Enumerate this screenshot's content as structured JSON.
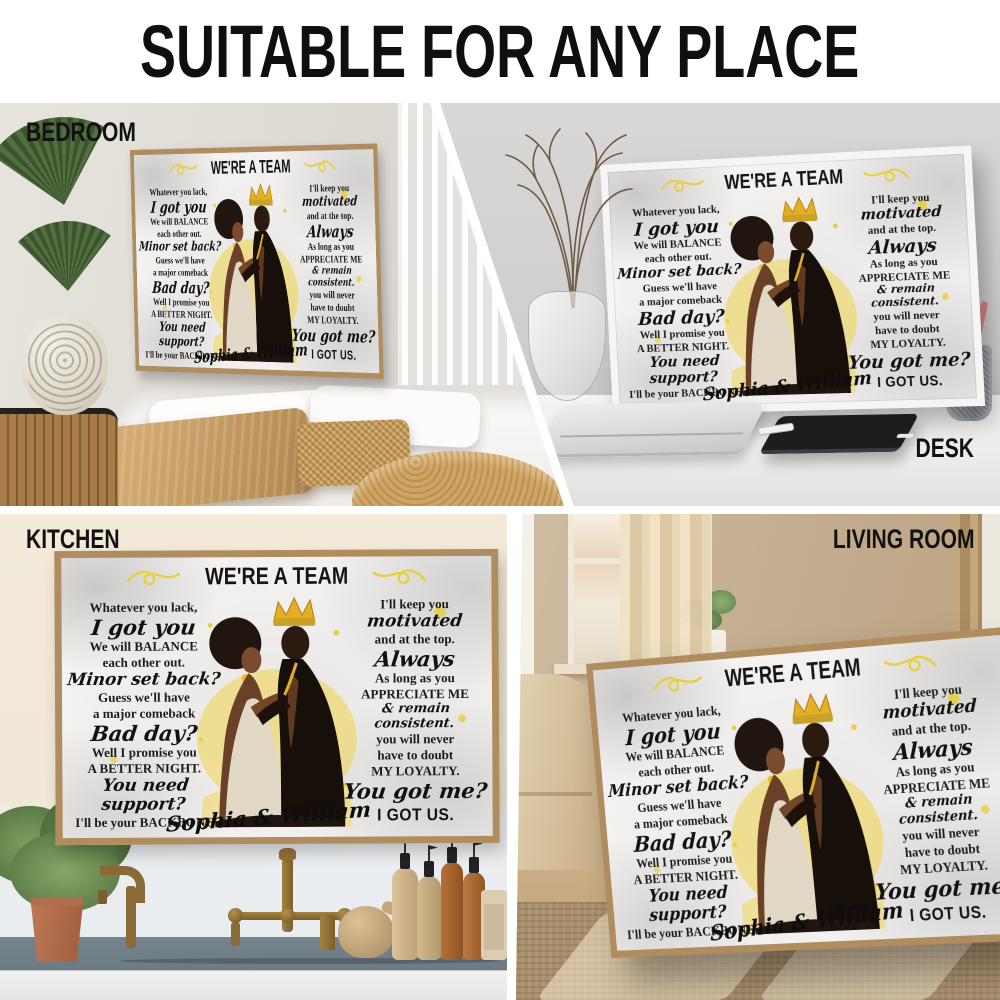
{
  "header": {
    "title": "SUITABLE FOR ANY PLACE"
  },
  "scenes": {
    "bedroom": {
      "label": "BEDROOM"
    },
    "desk": {
      "label": "DESK"
    },
    "kitchen": {
      "label": "KITCHEN"
    },
    "living_room": {
      "label": "LIVING ROOM"
    }
  },
  "poster": {
    "title": "WE'RE A TEAM",
    "names": "Sophia & William",
    "left_lines": [
      {
        "t": "Whatever you lack,",
        "s": "serif"
      },
      {
        "t": "I got you",
        "s": "script-lg"
      },
      {
        "t": "We will BALANCE",
        "s": "serif"
      },
      {
        "t": "each other out.",
        "s": "serif"
      },
      {
        "t": "Minor set back?",
        "s": "script"
      },
      {
        "t": "Guess we'll have",
        "s": "serif"
      },
      {
        "t": "a major comeback",
        "s": "serif"
      },
      {
        "t": "Bad day?",
        "s": "script-lg"
      },
      {
        "t": "Well I promise you",
        "s": "serif"
      },
      {
        "t": "A BETTER NIGHT.",
        "s": "serif"
      },
      {
        "t": "You need support?",
        "s": "script"
      },
      {
        "t": "I'll be your BACKBONE",
        "s": "serif"
      }
    ],
    "right_lines": [
      {
        "t": "I'll keep you",
        "s": "serif"
      },
      {
        "t": "motivated",
        "s": "script"
      },
      {
        "t": "and at the top.",
        "s": "serif"
      },
      {
        "t": "Always",
        "s": "script-lg"
      },
      {
        "t": "As long as you",
        "s": "serif"
      },
      {
        "t": "APPRECIATE ME",
        "s": "serif"
      },
      {
        "t": "& remain consistent.",
        "s": "script-sm"
      },
      {
        "t": "you will never",
        "s": "serif"
      },
      {
        "t": "have to doubt",
        "s": "serif"
      },
      {
        "t": "MY LOYALTY.",
        "s": "serif"
      },
      {
        "t": "You got me?",
        "s": "script-lg"
      },
      {
        "t": "I GOT US.",
        "s": "bold"
      }
    ],
    "icons": {
      "flourish": "swirl-flourish"
    },
    "colors": {
      "accent_yellow": "#e7cf3f",
      "frame_wood": "#b08d5f",
      "frame_white": "#f5f5f3",
      "art_gold": "#e0a92c",
      "text_black": "#1c1c1c"
    }
  }
}
